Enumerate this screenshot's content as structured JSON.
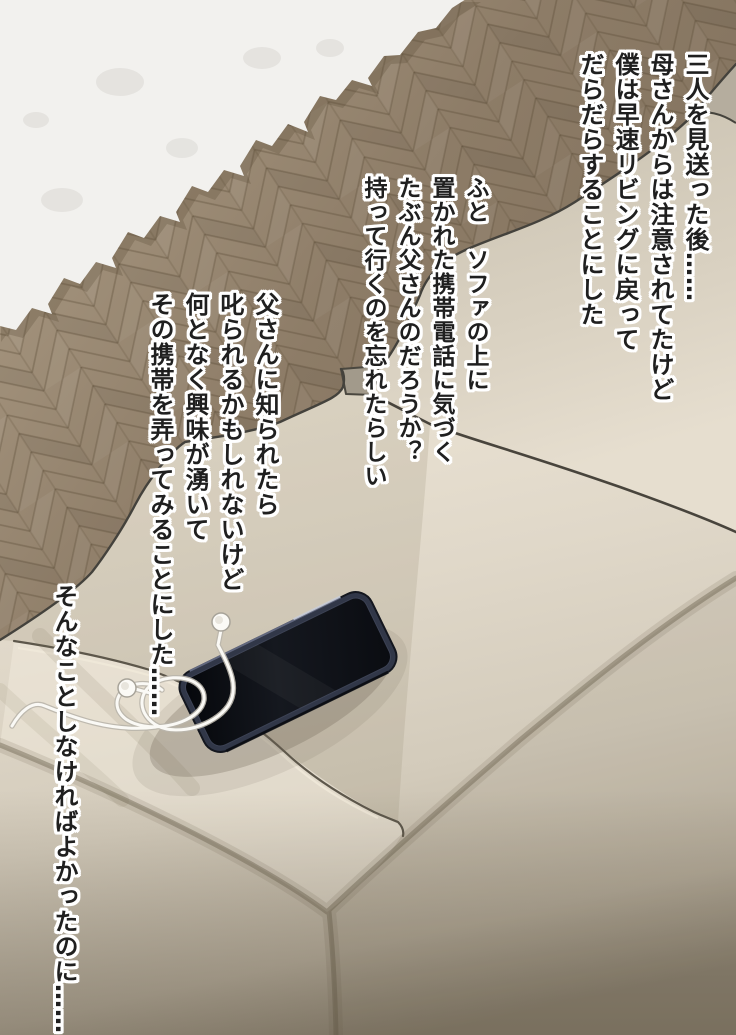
{
  "narration": {
    "text_color": "#1f1f1f",
    "outline_color": "#ffffff",
    "blocks": [
      {
        "id": "intro",
        "lines": [
          "三人を見送った後……",
          "母さんからは注意されてたけど",
          "僕は早速リビングに戻って",
          "だらだらすることにした"
        ]
      },
      {
        "id": "notice-phone",
        "lines": [
          "ふと　ソファの上に",
          "置かれた携帯電話に気づく",
          "たぶん父さんのだろうか？",
          "持って行くのを忘れたらしい"
        ]
      },
      {
        "id": "temptation",
        "lines": [
          "父さんに知られたら",
          "叱られるかもしれないけど",
          "何となく興味が湧いて",
          "その携帯を弄ってみることにした……"
        ]
      },
      {
        "id": "regret",
        "lines": [
          "そんなことしなければよかったのに……"
        ]
      }
    ]
  },
  "scene": {
    "objects": [
      "wood-floor",
      "white-rug",
      "beige-sofa",
      "smartphone",
      "earphones"
    ],
    "floor_color": "#8d7c67",
    "rug_color": "#f2f1ee",
    "sofa_color": "#d8d0c0",
    "sofa_shadow_color": "#8f8676",
    "outline_color": "#44423c",
    "phone_body_color": "#313748",
    "phone_screen_color": "#0b0d13",
    "earphone_color": "#faf9f5"
  }
}
